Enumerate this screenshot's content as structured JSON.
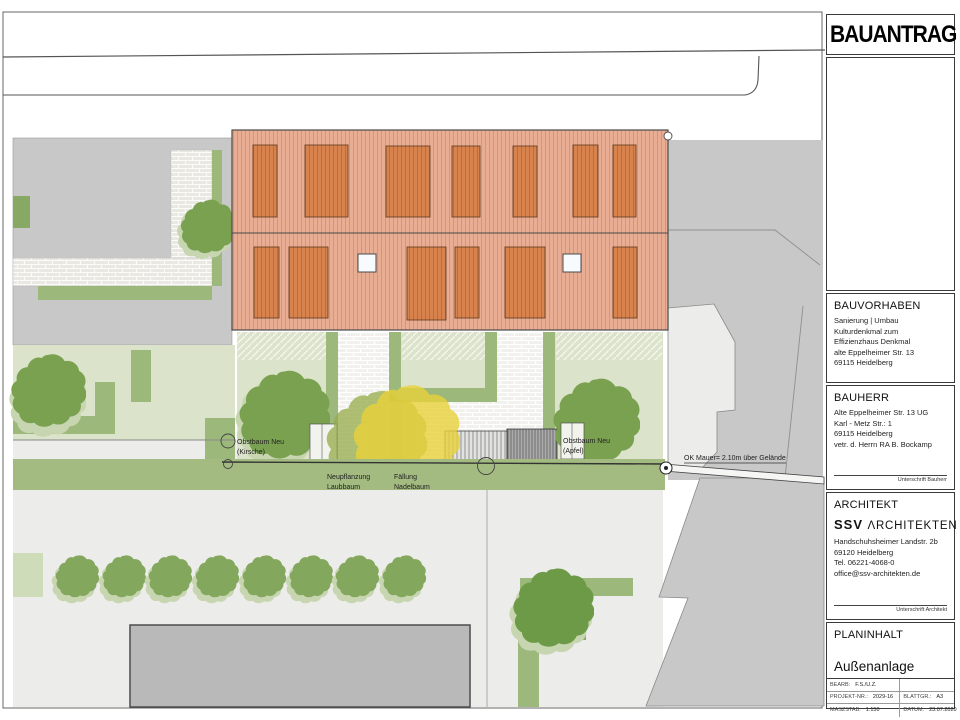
{
  "title_block": {
    "doc_type": "BAUANTRAG",
    "bauvorhaben": {
      "heading": "BAUVORHABEN",
      "lines": [
        "Sanierung | Umbau",
        "Kulturdenkmal zum",
        "Effizienzhaus Denkmal",
        "alte Eppelheimer Str. 13",
        "69115 Heidelberg"
      ]
    },
    "bauherr": {
      "heading": "BAUHERR",
      "lines": [
        "Alte Eppelheimer Str. 13 UG",
        "Karl - Metz Str.: 1",
        "69115 Heidelberg",
        "vetr. d. Herrn RA B. Bockamp"
      ],
      "signature_label": "Unterschrift Bauherr"
    },
    "architekt": {
      "heading": "ARCHITEKT",
      "logo_ssv": "SSV",
      "logo_rest": "ΛRCHITEKTEN",
      "lines": [
        "Handschuhsheimer Landstr. 2b",
        "69120 Heidelberg",
        "Tel. 06221-4068-0",
        "office@ssv-architekten.de"
      ],
      "signature_label": "Unterschrift Architekt"
    },
    "planinhalt": {
      "heading": "PLANINHALT",
      "plan_name": "Außenanlage"
    },
    "info_table": {
      "bearb_label": "BEARB:",
      "bearb_value": "F.S./U.Z.",
      "projekt_label": "PROJEKT-NR.:",
      "projekt_value": "2029-16",
      "blatt_label": "BLATTGR.:",
      "blatt_value": "A3",
      "massstab_label": "MASZSTAB:",
      "massstab_value": "1:150",
      "datum_label": "DATUM:",
      "datum_value": "23.07.2020"
    }
  },
  "plan": {
    "labels": {
      "obstbaum_kirsche_1": "Obstbaum Neu",
      "obstbaum_kirsche_2": "(Kirsche)",
      "neupflanzung_1": "Neupflanzung",
      "neupflanzung_2": "Laubbaum",
      "faellung_1": "Fällung",
      "faellung_2": "Nadelbaum",
      "obstbaum_apfel_1": "Obstbaum Neu",
      "obstbaum_apfel_2": "(Apfel)",
      "mauer": "OK Mauer= 2.10m über Gelände"
    },
    "colors": {
      "roof": "#e9ad94",
      "roof_panel": "#d8834e",
      "hedge_green": "#9cb87b",
      "lawn_pale": "#dbe3ca",
      "band_green": "#a3bb80",
      "tree_green": "#79a150",
      "felling_yellow": "#e9d23a",
      "paving_gray": "#c8c8c8"
    }
  }
}
